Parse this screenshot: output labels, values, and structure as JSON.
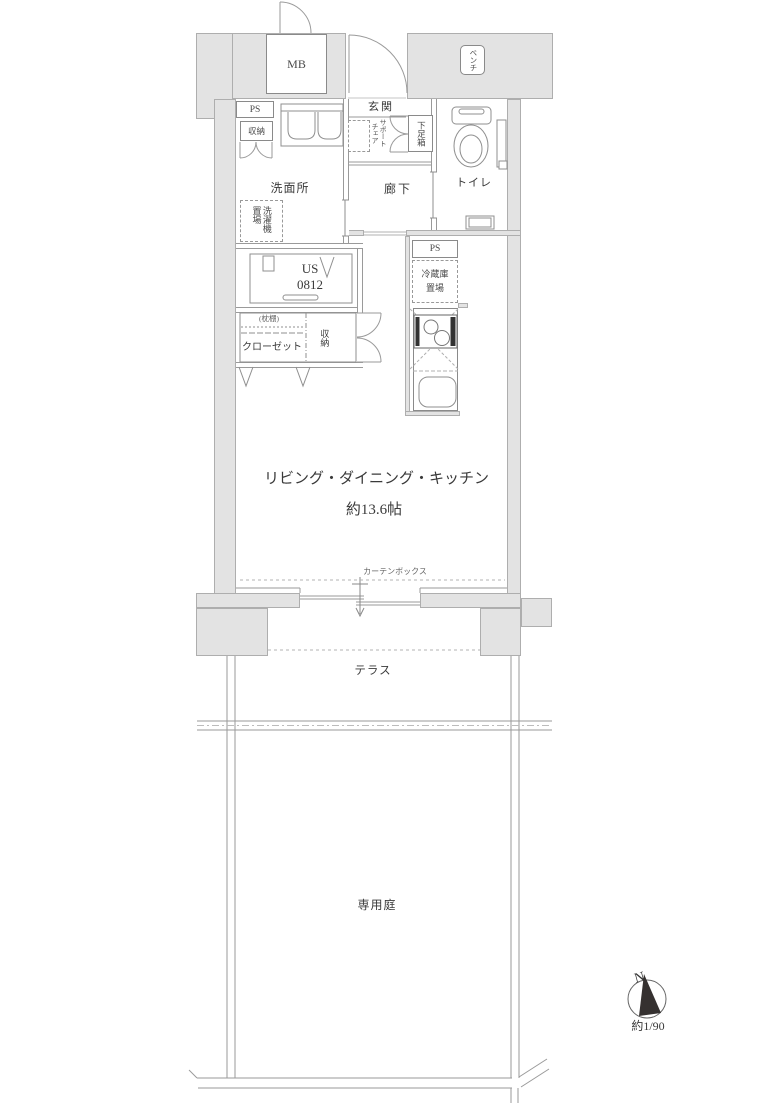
{
  "floor_plan": {
    "rooms": {
      "entrance": "玄関",
      "hallway": "廊下",
      "washroom": "洗面所",
      "toilet": "トイレ",
      "unit_bath_line1": "US",
      "unit_bath_line2": "0812",
      "ldk_line1": "リビング・ダイニング・キッチン",
      "ldk_line2": "約13.6帖",
      "terrace": "テラス",
      "private_garden": "専用庭"
    },
    "fixtures": {
      "meter_box": "MB",
      "bench": "ベンチ",
      "ps_upper": "PS",
      "ps_kitchen": "PS",
      "storage_upper": "収納",
      "storage_closet": "収納",
      "washing_machine_space": "洗濯機置場",
      "support_chair": "サポートチェア",
      "shoe_box": "下足箱",
      "refrigerator_space_line1": "冷蔵庫",
      "refrigerator_space_line2": "置場",
      "pillow_shelf": "(枕棚)",
      "closet": "クローゼット",
      "curtain_box": "カーテンボックス"
    },
    "compass": {
      "north": "N",
      "scale": "約1/90"
    },
    "colors": {
      "wall_fill": "#e3e3e3",
      "wall_border": "#aeaeae",
      "line": "#9a9a9a",
      "text": "#3a3a3a",
      "compass_needle": "#353130"
    }
  }
}
